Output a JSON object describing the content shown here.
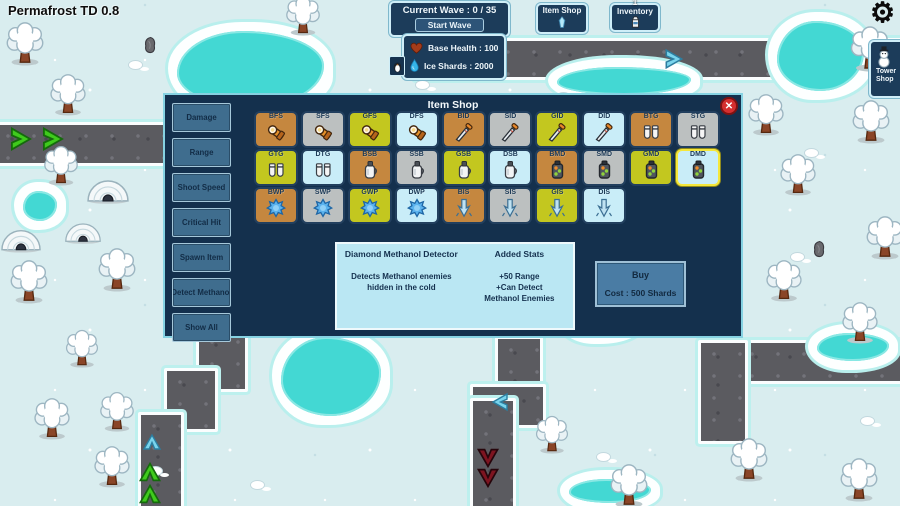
{
  "game": {
    "title": "Permafrost TD 0.8"
  },
  "hud": {
    "wave_label": "Current Wave : 0 / 35",
    "start_button": "Start Wave",
    "base_health": "Base Health : 100",
    "ice_shards": "Ice Shards : 2000",
    "item_shop_button": "Item Shop",
    "inventory_button": "Inventory",
    "inventory_count": "1",
    "tower_shop_button": "Tower Shop"
  },
  "icons": {
    "close": "✕",
    "gear": "⚙"
  },
  "shop": {
    "title": "Item Shop",
    "filters": [
      "Damage",
      "Range",
      "Shoot Speed",
      "Critical Hit",
      "Spawn Item",
      "Detect Methanol",
      "Show All"
    ],
    "items": [
      {
        "label": "BFS",
        "tier": "bronze",
        "icon": "flashlight-icon"
      },
      {
        "label": "SFS",
        "tier": "silver",
        "icon": "flashlight-icon"
      },
      {
        "label": "GFS",
        "tier": "gold",
        "icon": "flashlight-icon"
      },
      {
        "label": "DFS",
        "tier": "diamond",
        "icon": "flashlight-icon"
      },
      {
        "label": "BID",
        "tier": "bronze",
        "icon": "dagger-icon"
      },
      {
        "label": "SID",
        "tier": "silver",
        "icon": "dagger-icon"
      },
      {
        "label": "GID",
        "tier": "gold",
        "icon": "dagger-icon"
      },
      {
        "label": "DID",
        "tier": "diamond",
        "icon": "dagger-icon"
      },
      {
        "label": "BTG",
        "tier": "bronze",
        "icon": "gloves-icon"
      },
      {
        "label": "STG",
        "tier": "silver",
        "icon": "gloves-icon"
      },
      {
        "label": "GTG",
        "tier": "gold",
        "icon": "gloves-icon"
      },
      {
        "label": "DTG",
        "tier": "diamond",
        "icon": "gloves-icon"
      },
      {
        "label": "BSB",
        "tier": "bronze",
        "icon": "jug-icon"
      },
      {
        "label": "SSB",
        "tier": "silver",
        "icon": "jug-icon"
      },
      {
        "label": "GSB",
        "tier": "gold",
        "icon": "jug-icon"
      },
      {
        "label": "DSB",
        "tier": "diamond",
        "icon": "jug-icon"
      },
      {
        "label": "BMD",
        "tier": "bronze",
        "icon": "detector-icon"
      },
      {
        "label": "SMD",
        "tier": "silver",
        "icon": "detector-icon"
      },
      {
        "label": "GMD",
        "tier": "gold",
        "icon": "detector-icon"
      },
      {
        "label": "DMD",
        "tier": "diamond",
        "icon": "detector-icon",
        "selected": true
      },
      {
        "label": "BWP",
        "tier": "bronze",
        "icon": "splat-icon"
      },
      {
        "label": "SWP",
        "tier": "silver",
        "icon": "splat-icon"
      },
      {
        "label": "GWP",
        "tier": "gold",
        "icon": "splat-icon"
      },
      {
        "label": "DWP",
        "tier": "diamond",
        "icon": "splat-icon"
      },
      {
        "label": "BIS",
        "tier": "bronze",
        "icon": "spike-icon"
      },
      {
        "label": "SIS",
        "tier": "silver",
        "icon": "spike-icon"
      },
      {
        "label": "GIS",
        "tier": "gold",
        "icon": "spike-icon"
      },
      {
        "label": "DIS",
        "tier": "diamond",
        "icon": "spike-icon"
      }
    ],
    "detail": {
      "name": "Diamond Methanol Detector",
      "stats_heading": "Added Stats",
      "description": "Detects Methanol enemies\nhidden in the cold",
      "stats": "+50 Range\n+Can Detect\nMethanol Enemies",
      "buy_label": "Buy",
      "cost_label": "Cost : 500 Shards"
    }
  },
  "colors": {
    "bronze": "#c5873f",
    "silver": "#bcc0c0",
    "gold": "#c3c71f",
    "diamond": "#c9edf8",
    "selected_border": "#f5e73b",
    "dialog_bg": "#14304d",
    "water": "#43d8d3",
    "path": "#5b5b60",
    "snow": "#d9edef"
  }
}
